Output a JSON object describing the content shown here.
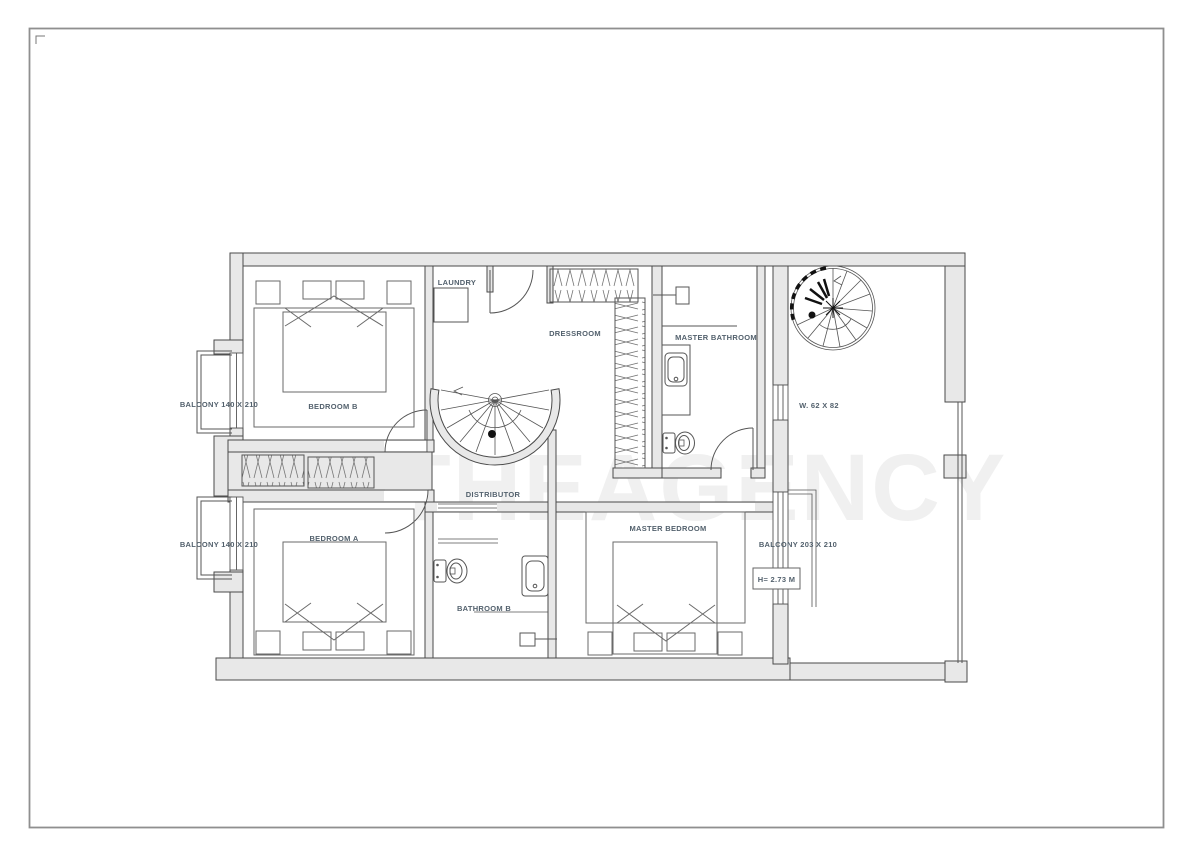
{
  "watermark": "THEAGENCY",
  "palette": {
    "wall_fill": "#e8e8e8",
    "wall_line": "#4a4a4a",
    "thin_line": "#555555",
    "label_color": "#53616d",
    "page_border": "#8f8f8f",
    "watermark_color": "#efefef"
  },
  "labels": {
    "laundry": "LAUNDRY",
    "dressroom": "DRESSROOM",
    "master_bathroom": "MASTER BATHROOM",
    "bedroom_b": "BEDROOM B",
    "balcony_top_left": "BALCONY 140 X 210",
    "window_size": "W. 62 X 82",
    "distributor": "DISTRIBUTOR",
    "bedroom_a": "BEDROOM A",
    "balcony_bottom_left": "BALCONY 140 X 210",
    "master_bedroom": "MASTER BEDROOM",
    "balcony_right": "BALCONY 203 X 210",
    "bathroom_b": "BATHROOM B",
    "height_note": "H= 2.73 M"
  }
}
